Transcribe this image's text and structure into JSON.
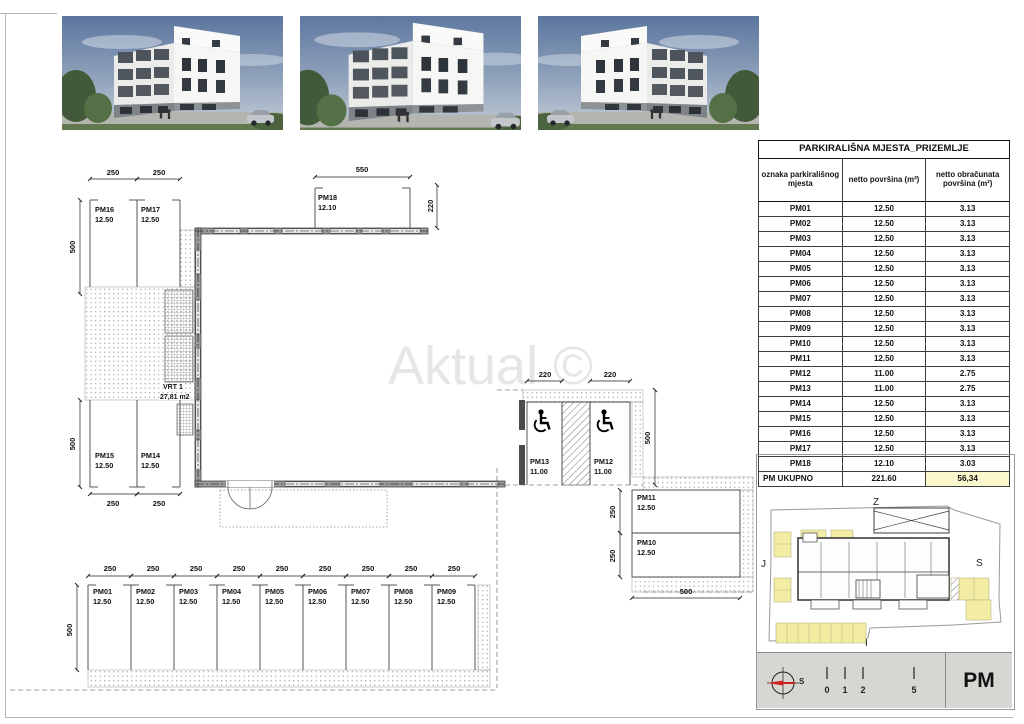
{
  "watermark": "Aktual ©",
  "table": {
    "title": "PARKIRALIŠNA MJESTA_PRIZEMLJE",
    "columns": [
      "oznaka parkirališnog mjesta",
      "netto površina (m²)",
      "netto obračunata površina (m²)"
    ],
    "rows": [
      {
        "id": "PM01",
        "netto": "12.50",
        "obracunata": "3.13"
      },
      {
        "id": "PM02",
        "netto": "12.50",
        "obracunata": "3.13"
      },
      {
        "id": "PM03",
        "netto": "12.50",
        "obracunata": "3.13"
      },
      {
        "id": "PM04",
        "netto": "12.50",
        "obracunata": "3.13"
      },
      {
        "id": "PM05",
        "netto": "12.50",
        "obracunata": "3.13"
      },
      {
        "id": "PM06",
        "netto": "12.50",
        "obracunata": "3.13"
      },
      {
        "id": "PM07",
        "netto": "12.50",
        "obracunata": "3.13"
      },
      {
        "id": "PM08",
        "netto": "12.50",
        "obracunata": "3.13"
      },
      {
        "id": "PM09",
        "netto": "12.50",
        "obracunata": "3.13"
      },
      {
        "id": "PM10",
        "netto": "12.50",
        "obracunata": "3.13"
      },
      {
        "id": "PM11",
        "netto": "12.50",
        "obracunata": "3.13"
      },
      {
        "id": "PM12",
        "netto": "11.00",
        "obracunata": "2.75"
      },
      {
        "id": "PM13",
        "netto": "11.00",
        "obracunata": "2.75"
      },
      {
        "id": "PM14",
        "netto": "12.50",
        "obracunata": "3.13"
      },
      {
        "id": "PM15",
        "netto": "12.50",
        "obracunata": "3.13"
      },
      {
        "id": "PM16",
        "netto": "12.50",
        "obracunata": "3.13"
      },
      {
        "id": "PM17",
        "netto": "12.50",
        "obracunata": "3.13"
      },
      {
        "id": "PM18",
        "netto": "12.10",
        "obracunata": "3.03"
      }
    ],
    "total": {
      "id": "PM UKUPNO",
      "netto": "221.60",
      "obracunata": "56,34"
    }
  },
  "plan": {
    "dims": {
      "d220": "220",
      "d250": "250",
      "d500": "500",
      "d550": "550"
    },
    "garden": {
      "name": "VRT 1",
      "area": "27,81 m2"
    },
    "stalls": [
      {
        "id": "PM01",
        "area": "12.50"
      },
      {
        "id": "PM02",
        "area": "12.50"
      },
      {
        "id": "PM03",
        "area": "12.50"
      },
      {
        "id": "PM04",
        "area": "12.50"
      },
      {
        "id": "PM05",
        "area": "12.50"
      },
      {
        "id": "PM06",
        "area": "12.50"
      },
      {
        "id": "PM07",
        "area": "12.50"
      },
      {
        "id": "PM08",
        "area": "12.50"
      },
      {
        "id": "PM09",
        "area": "12.50"
      },
      {
        "id": "PM10",
        "area": "12.50"
      },
      {
        "id": "PM11",
        "area": "12.50"
      },
      {
        "id": "PM12",
        "area": "11.00"
      },
      {
        "id": "PM13",
        "area": "11.00"
      },
      {
        "id": "PM14",
        "area": "12.50"
      },
      {
        "id": "PM15",
        "area": "12.50"
      },
      {
        "id": "PM16",
        "area": "12.50"
      },
      {
        "id": "PM17",
        "area": "12.50"
      },
      {
        "id": "PM18",
        "area": "12.10"
      }
    ]
  },
  "siteplan": {
    "top": "Z",
    "left": "J",
    "right": "S",
    "bottom": "I"
  },
  "titleblock": {
    "compass_label": "S",
    "scale": [
      "0",
      "1",
      "2",
      "5"
    ],
    "code": "PM"
  }
}
